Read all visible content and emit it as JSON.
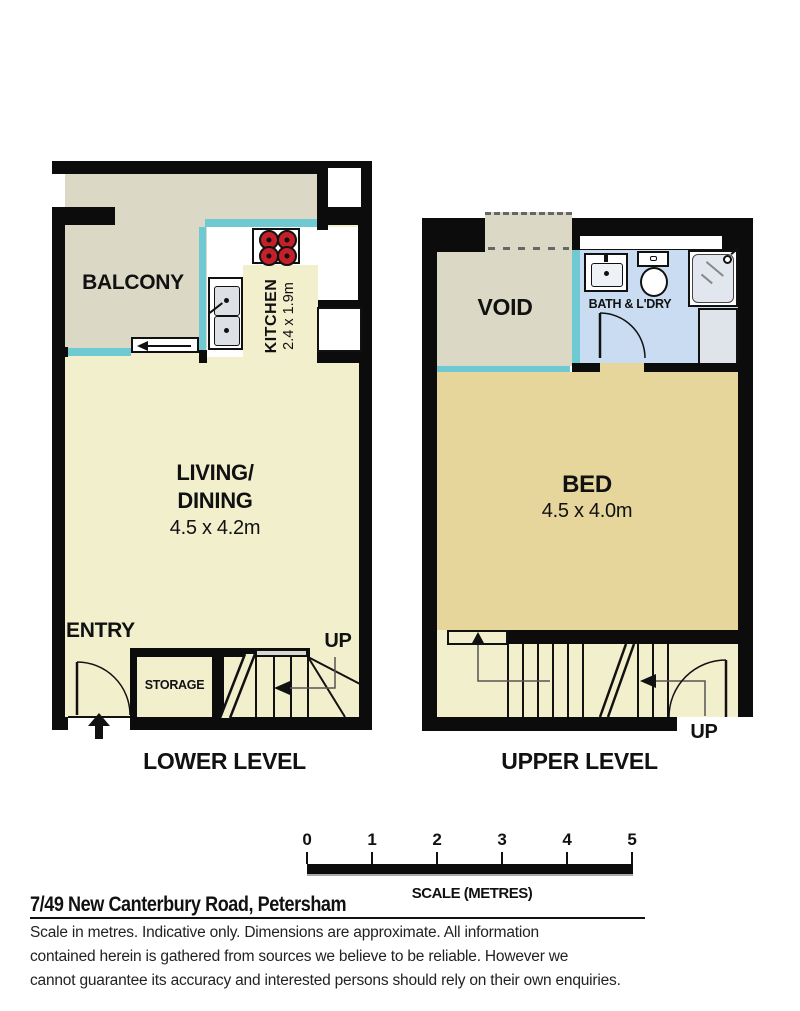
{
  "plan": {
    "lower": {
      "caption": "LOWER LEVEL",
      "balcony_label": "BALCONY",
      "kitchen_label": "KITCHEN",
      "kitchen_dims": "2.4 x 1.9m",
      "living_label_line1": "LIVING/",
      "living_label_line2": "DINING",
      "living_dims": "4.5 x 4.2m",
      "entry_label": "ENTRY",
      "storage_label": "STORAGE",
      "up_label": "UP"
    },
    "upper": {
      "caption": "UPPER LEVEL",
      "void_label": "VOID",
      "bath_label": "BATH & L'DRY",
      "bed_label": "BED",
      "bed_dims": "4.5 x 4.0m",
      "up_label": "UP"
    }
  },
  "scale_bar": {
    "ticks": [
      "0",
      "1",
      "2",
      "3",
      "4",
      "5"
    ],
    "label": "SCALE (METRES)"
  },
  "footer": {
    "address": "7/49 New Canterbury Road, Petersham",
    "disclaimer_lines": [
      "Scale in metres. Indicative only. Dimensions are approximate. All information",
      "contained herein is gathered from sources we believe to be reliable. However we",
      "cannot guarantee its accuracy and interested persons should rely on their own enquiries."
    ]
  },
  "colors": {
    "wall": "#0c0c0c",
    "living_floor": "#f2efcd",
    "balcony_void_floor": "#dbd8c6",
    "bed_floor": "#e7d69c",
    "bath_floor": "#c9dcf1",
    "window": "#6fc9d2",
    "burner_red": "#c4202a"
  }
}
